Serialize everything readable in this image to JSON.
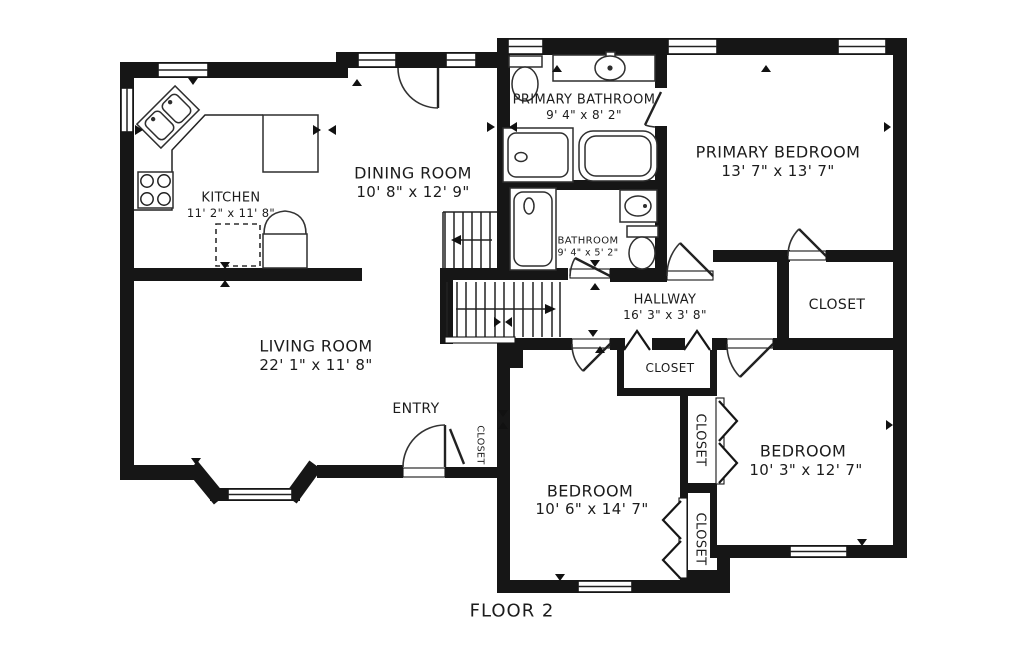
{
  "title": "FLOOR 2",
  "rooms": {
    "kitchen": {
      "name": "KITCHEN",
      "dims": "11' 2\" x 11' 8\""
    },
    "dining": {
      "name": "DINING ROOM",
      "dims": "10' 8\" x 12' 9\""
    },
    "primary_bathroom": {
      "name": "PRIMARY BATHROOM",
      "dims": "9' 4\" x 8' 2\""
    },
    "primary_bedroom": {
      "name": "PRIMARY BEDROOM",
      "dims": "13' 7\" x 13' 7\""
    },
    "bathroom": {
      "name": "BATHROOM",
      "dims": "9' 4\" x 5' 2\""
    },
    "hallway": {
      "name": "HALLWAY",
      "dims": "16' 3\" x 3' 8\""
    },
    "living_room": {
      "name": "LIVING ROOM",
      "dims": "22' 1\" x 11' 8\""
    },
    "entry": {
      "name": "ENTRY"
    },
    "bedroom_center": {
      "name": "BEDROOM",
      "dims": "10' 6\" x 14' 7\""
    },
    "bedroom_right": {
      "name": "BEDROOM",
      "dims": "10' 3\" x 12' 7\""
    }
  },
  "closets": {
    "primary": {
      "name": "CLOSET"
    },
    "hallway": {
      "name": "CLOSET"
    },
    "entry": {
      "name": "CLOSET"
    },
    "between_top": {
      "name": "CLOSET"
    },
    "between_bottom": {
      "name": "CLOSET"
    }
  },
  "colors": {
    "wall": "#161616",
    "background": "#ffffff",
    "text": "#1c1c1c"
  }
}
